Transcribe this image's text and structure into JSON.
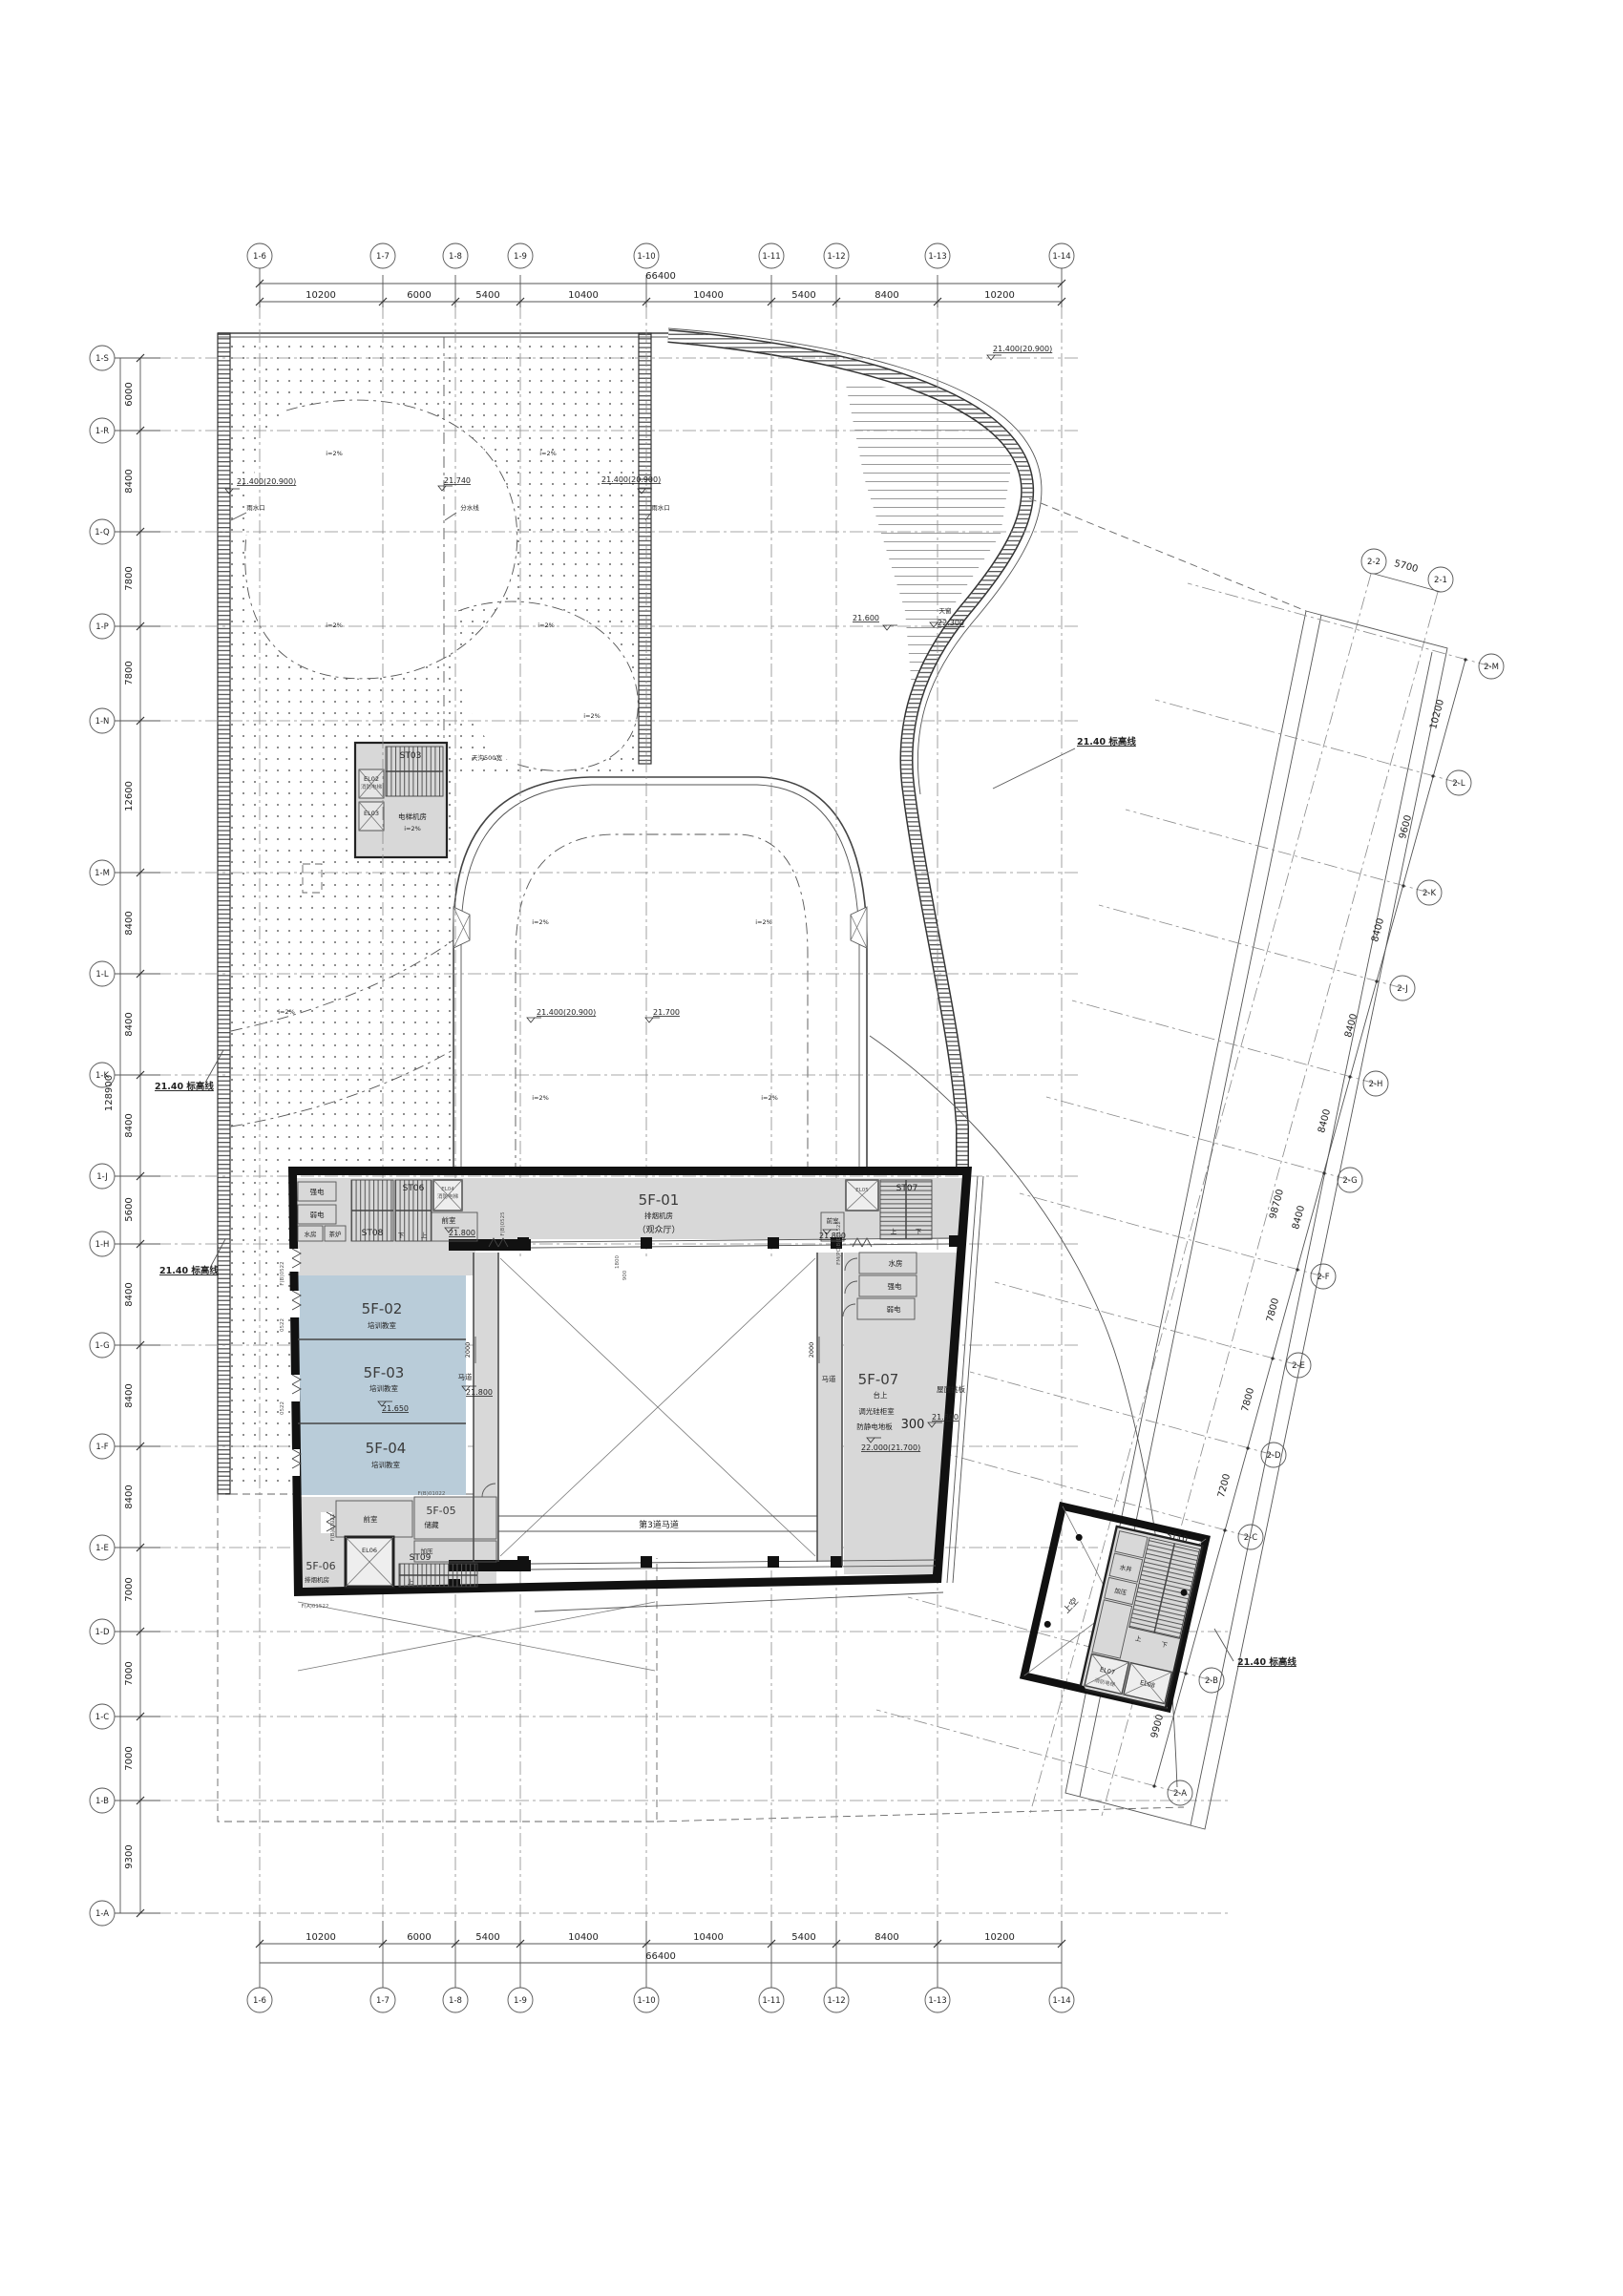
{
  "colors": {
    "classroom_blue": "#b9ccd9",
    "room_gray": "#d8d8d8",
    "wall_black": "#111111",
    "line": "#444444",
    "grid_dash": "#8a8a8a"
  },
  "grid_h": {
    "bubbles": [
      "1-6",
      "1-7",
      "1-8",
      "1-9",
      "1-10",
      "1-11",
      "1-12",
      "1-13",
      "1-14"
    ],
    "segments": [
      "10200",
      "6000",
      "5400",
      "10400",
      "10400",
      "5400",
      "8400",
      "10200"
    ],
    "overall": "66400"
  },
  "grid_left": {
    "bubbles": [
      "1-S",
      "1-R",
      "1-Q",
      "1-P",
      "1-N",
      "1-M",
      "1-L",
      "1-K",
      "1-J",
      "1-H",
      "1-G",
      "1-F",
      "1-E",
      "1-D",
      "1-C",
      "1-B",
      "1-A"
    ],
    "segments": [
      "6000",
      "8400",
      "7800",
      "7800",
      "12600",
      "8400",
      "8400",
      "8400",
      "5600",
      "8400",
      "8400",
      "8400",
      "7000",
      "7000",
      "7000",
      "9300"
    ],
    "overall": "128900"
  },
  "grid_right": {
    "bubbles": [
      "2-M",
      "2-L",
      "2-K",
      "2-J",
      "2-H",
      "2-G",
      "2-F",
      "2-E",
      "2-D",
      "2-C",
      "2-B",
      "2-A"
    ],
    "segments": [
      "10200",
      "9600",
      "8400",
      "8400",
      "8400",
      "8400",
      "7800",
      "7800",
      "7200",
      "12600",
      "9900"
    ],
    "overall": "98700",
    "top_bubbles": [
      "2-2",
      "2-1"
    ],
    "top_segment": "5700"
  },
  "rooms": {
    "f01": {
      "code": "5F-01",
      "name": "排烟机房",
      "note": "（观众厅）"
    },
    "f02": {
      "code": "5F-02",
      "name": "培训教室"
    },
    "f03": {
      "code": "5F-03",
      "name": "培训教室",
      "level": "21.650"
    },
    "f04": {
      "code": "5F-04",
      "name": "培训教室"
    },
    "f05": {
      "code": "5F-05",
      "name": "储藏"
    },
    "f06": {
      "code": "5F-06",
      "name": "排烟机房"
    },
    "f07": {
      "code": "5F-07",
      "line1": "台上",
      "line2": "调光硅柜室",
      "line3": "防静电地板",
      "level": "22.000(21.700)",
      "num": "300"
    }
  },
  "labels": {
    "qiangdian": "强电",
    "ruodian": "弱电",
    "shuifang": "水房",
    "chalu": "茶炉",
    "qianshi": "前室",
    "jiaya": "加压",
    "shuijing": "水井",
    "madao": "马道",
    "madao3": "第3道马道",
    "shangkong": "上空",
    "eleroom": "电梯机房",
    "up": "上",
    "down": "下",
    "fire_lift": "消防电梯"
  },
  "stairs": {
    "st03": "ST03",
    "st06": "ST06",
    "st07": "ST07",
    "st08": "ST08",
    "st09": "ST09",
    "st10": "ST10"
  },
  "lifts": {
    "el02": "EL02",
    "el03": "EL03",
    "el04": "EL04",
    "el05": "EL05",
    "el06": "EL06",
    "el07": "EL07",
    "el08": "EL08"
  },
  "levels": {
    "mark_line": "21.40 标高线",
    "l21400": "21.400(20.900)",
    "l21740": "21.740",
    "l21700": "21.700",
    "l21800": "21.800",
    "l21600": "21.600",
    "l22300": "22.300"
  },
  "annotations": {
    "slope": "i=2%",
    "fenshuixian": "分水线",
    "yushuikou": "雨水口",
    "tianchuang": "天窗",
    "tiangou": "天沟500宽",
    "wumian": "屋面挑板",
    "dim2000": "2000",
    "dim1800": "1800",
    "dim900": "900"
  },
  "door_tags": {
    "t1": "F(B)0525",
    "t2": "F(B)0522",
    "t3": "F(B)01021",
    "t4": "F(B)01022",
    "t5": "F(A)01522",
    "t6": "FM(PC)B(D)1522",
    "t7": "0522"
  }
}
